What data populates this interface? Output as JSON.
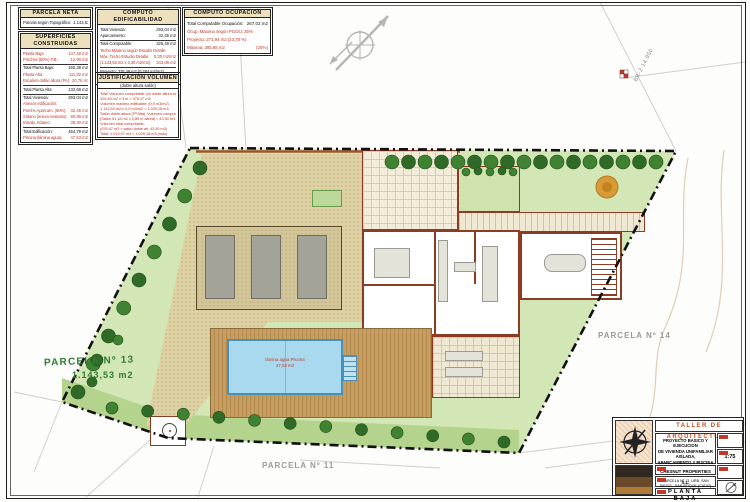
{
  "tables": {
    "parcela_neta": {
      "title": "PARCELA  NETA",
      "rows": [
        {
          "label": "Parcela según Topográfico:",
          "value": "1.143,53 m2"
        }
      ]
    },
    "superficies": {
      "title": "SUPERFICIES CONSTRUIDAS",
      "rows": [
        {
          "label": "Planta Baja:",
          "value": "147,48 m2",
          "red": true
        },
        {
          "label": "Porches (50%) P.B.:",
          "value": "12,90 m2",
          "red": true
        },
        {
          "label": "Total Planta Baja:",
          "value": "160,38 m2",
          "rule": true
        },
        {
          "label": "Planta Alta:",
          "value": "111,92 m2",
          "red": true
        },
        {
          "label": "Escalera doble altura (PA):",
          "value": "20,76 m2",
          "red": true
        },
        {
          "label": "Total Planta Alta:",
          "value": "132,68 m2",
          "rule": true
        },
        {
          "label": "Total Vivienda:",
          "value": "293,04 m2",
          "rule": true
        },
        {
          "label": "Anexos edificación:",
          "value": "",
          "red": true
        },
        {
          "label": "Porche Aparcam. (50%):",
          "value": "32,45 m2",
          "red": true
        },
        {
          "label": "Sótano (anexo vivienda):",
          "value": "80,89 m2",
          "red": true
        },
        {
          "label": "Instala. Sótano:",
          "value": "38,30 m2",
          "red": true
        },
        {
          "label": "Total Edificación:",
          "value": "454,79 m2",
          "rule": true
        },
        {
          "label": "Piscina (lámina agua):",
          "value": "47,53 m2",
          "red": true
        }
      ]
    },
    "computo_edificabilidad": {
      "title": "COMPUTO EDIFICABILIDAD",
      "rows": [
        {
          "label": "Total Vivienda:",
          "value": "293,04 m2"
        },
        {
          "label": "Aparcamiento:",
          "value": "32,45 m2"
        },
        {
          "label": "Total Computable:",
          "value": "325,49 m2",
          "rule": true
        },
        {
          "label": "Techo Máximo según Estudio Detalle",
          "value": "",
          "red": true
        },
        {
          "label": "Máx. Techo Estudio Detalle:",
          "value": "0,30 m2/m2",
          "red": true
        },
        {
          "label": "(1.143,53 m2 x 0,30 m2/m2):",
          "value": "343,06 m2",
          "red": true
        },
        {
          "label": "Proyecto: 325,49 m2 (0,284 m2/m2)",
          "value": "",
          "rule": true
        },
        {
          "label": "Proyecto: 325,49 m2 < 343,06 m2 (máximo)",
          "value": ""
        }
      ]
    },
    "justificacion_volumen": {
      "title": "JUSTIFICACION VOLUMEN",
      "subtitle": "(doble altura salón)",
      "lines": [
        {
          "text": "Total Volumen computable (no doble altura salón):",
          "red": true
        },
        {
          "text": "325,49 m2 x 3 m = 976,47 m3",
          "red": true
        },
        {
          "text": "Volumen máximo edificable: (0,9 m3/m2)",
          "red": true
        },
        {
          "text": "1.143,53 m2 x 0,9 m3/m2 = 1.029,18 m3",
          "red": true
        },
        {
          "text": "Salón doble altura (Pª Alta): Volumen computable:",
          "red": true
        },
        {
          "text": "(Salón 51,18 m2 x 0,85 m altura) = 43,50 m3",
          "red": true
        },
        {
          "text": "Volumen total computable:",
          "red": true
        },
        {
          "text": "(976,47 m3 + salón doble alt. 43,50 m3)",
          "red": true
        },
        {
          "text": "Total: 1.019,97 m3 < 1.029,18 m3 (máx)",
          "red": true
        }
      ]
    },
    "computo_ocupacion": {
      "title": "COMPUTO OCUPACION",
      "rows": [
        {
          "label": "Total Computable Ocupación:",
          "value": "267,03 m2"
        },
        {
          "label": "Ocup. Máxima según PGOU: 25%",
          "value": "",
          "red": true
        },
        {
          "label": "Proyecto: 271,94 m2 (23,78 %)",
          "value": "",
          "red": true
        },
        {
          "label": "Máxima: 285,88 m2",
          "value": "(25%)",
          "red": true
        }
      ]
    }
  },
  "plan": {
    "parcel13_label": "PARCELA Nº 13",
    "parcel13_area": "1.143,53 m2",
    "parcel14_label": "PARCELA Nº 14",
    "parcel11_label": "PARCELA Nº 11",
    "pool_label_line1": "lámina agua Piscina",
    "pool_label_line2": "47,53 m2",
    "survey_marker_label": "BR-2 14.950"
  },
  "title_block": {
    "studio": "TALLER DE ARQUITECTURA",
    "project_line1": "PROYECTO BASICO Y EJECUCION",
    "project_line2": "DE VIVIENDA UNIFAMILIAR AISLADA,",
    "project_line3": "APARCAMIENTO Y PISCINA",
    "client": "CHESNUT PROPERTIES S.L.",
    "location": "PARCELA Nº 13, URB. SAN DIEGO - SAN ROQUE (CADIZ)",
    "drawing_title": "PLANTA BAJA",
    "scale": "1:75"
  },
  "colors": {
    "accent_red": "#c0392b",
    "hedge_green": "#3c7d2e",
    "lawn_green": "#d3e6b6",
    "pool_blue": "#a8d9ee",
    "wall_brown": "#8c3b24",
    "gravel": "#ded2a4",
    "orange_tree": "#d89a35"
  }
}
